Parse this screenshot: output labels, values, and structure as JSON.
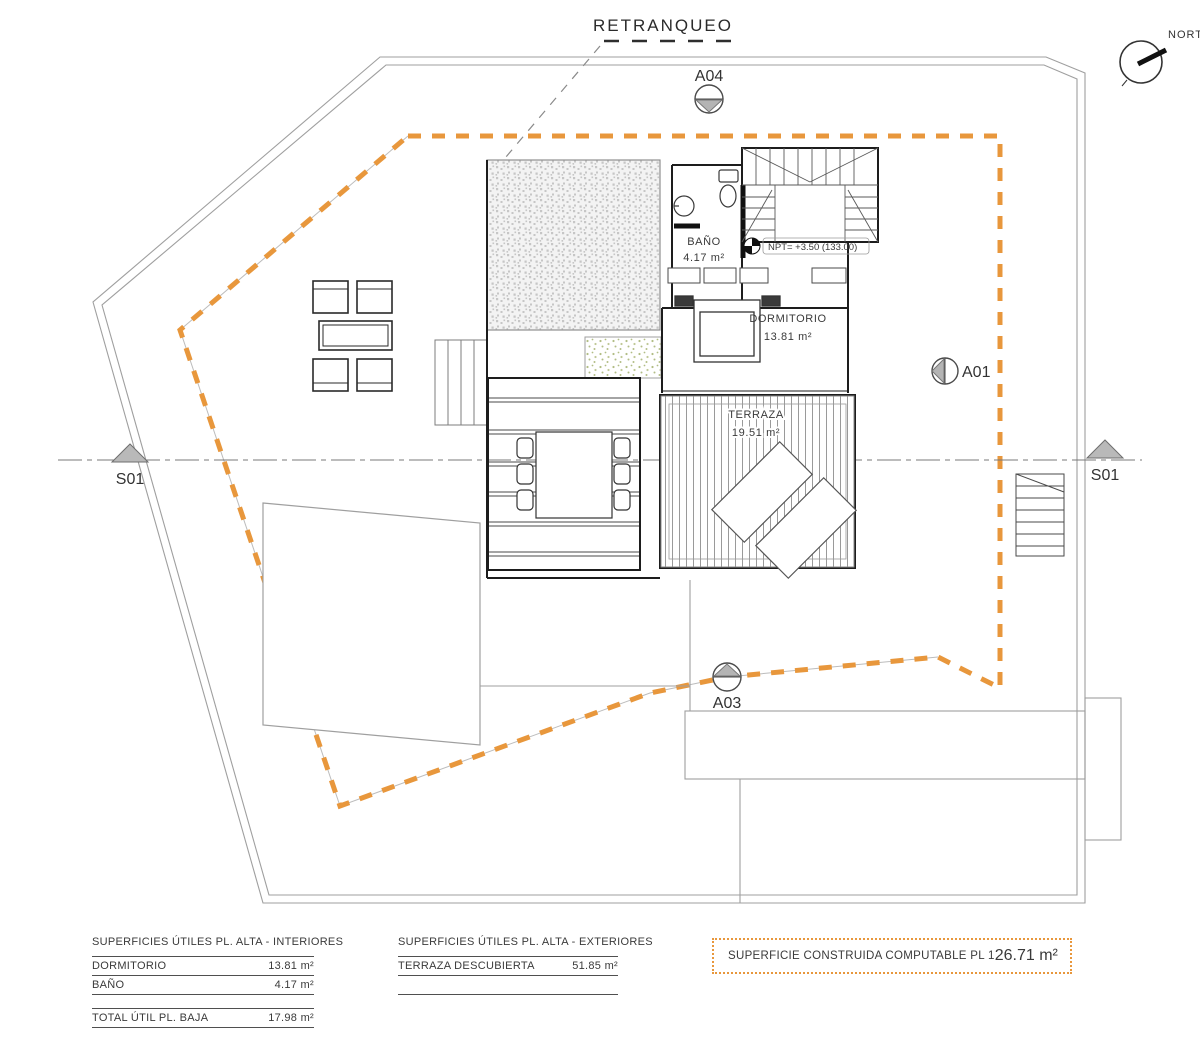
{
  "drawing": {
    "setback_label": "RETRANQUEO",
    "north_label": "NORTE",
    "level_note": "NPT= +3.50 (133.00)",
    "markers": {
      "a04": "A04",
      "a01": "A01",
      "a03": "A03",
      "s01": "S01"
    },
    "rooms": {
      "bano": {
        "name": "BAÑO",
        "area": "4.17 m²"
      },
      "dormitorio": {
        "name": "DORMITORIO",
        "area": "13.81 m²"
      },
      "terraza": {
        "name": "TERRAZA",
        "area": "19.51 m²"
      }
    },
    "colors": {
      "boundary_orange": "#E8973C",
      "walls": "#1d1d1d",
      "plot_line": "#9f9f9f"
    }
  },
  "tables": {
    "interiors": {
      "title": "SUPERFICIES ÚTILES PL. ALTA - INTERIORES",
      "rows": [
        {
          "label": "DORMITORIO",
          "value": "13.81 m²"
        },
        {
          "label": "BAÑO",
          "value": "4.17 m²"
        }
      ],
      "total": {
        "label": "TOTAL ÚTIL PL. BAJA",
        "value": "17.98 m²"
      }
    },
    "exteriors": {
      "title": "SUPERFICIES ÚTILES PL. ALTA - EXTERIORES",
      "rows": [
        {
          "label": "TERRAZA DESCUBIERTA",
          "value": "51.85 m²"
        }
      ]
    },
    "computable": {
      "label": "SUPERFICIE CONSTRUIDA COMPUTABLE PL 1",
      "value": "26.71 m²"
    }
  }
}
